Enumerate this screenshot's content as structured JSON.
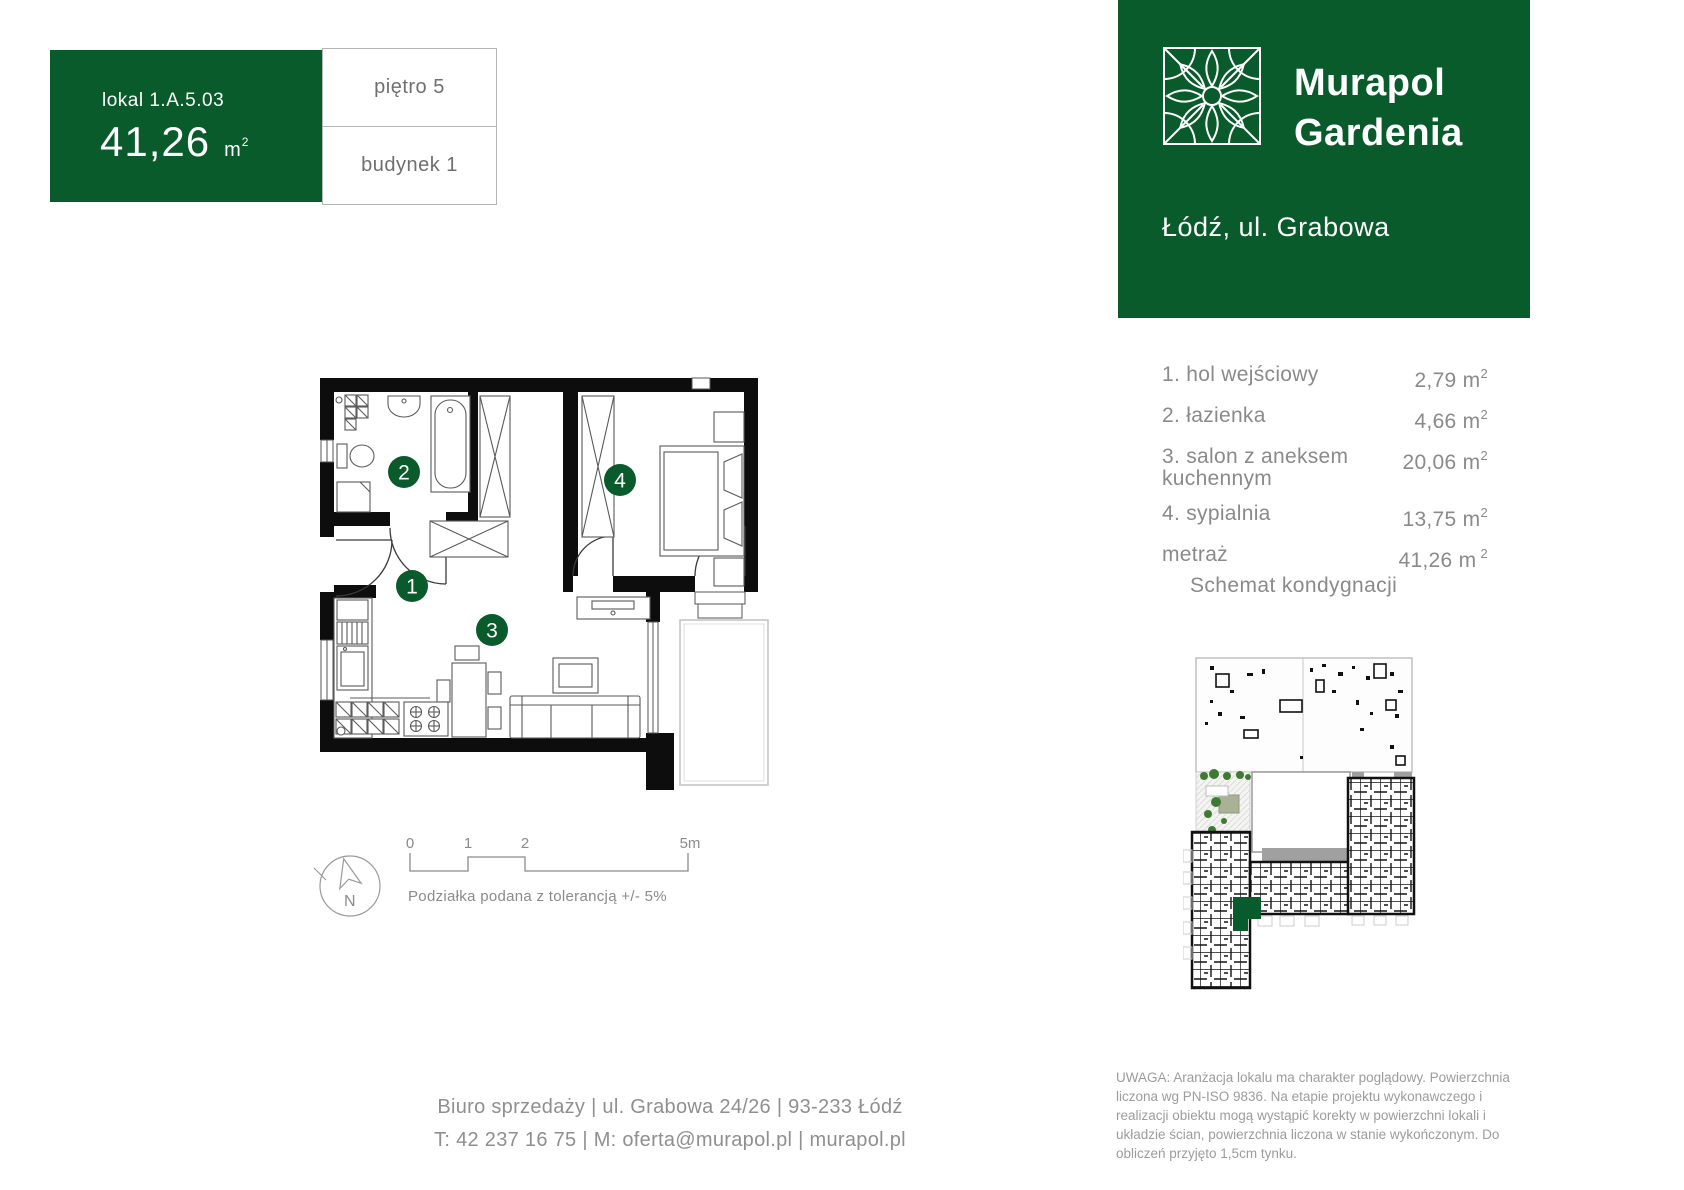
{
  "colors": {
    "brand_green": "#0a5b2c",
    "text_gray": "#8a8a8a"
  },
  "unit_card": {
    "lokal": "lokal 1.A.5.03",
    "area": "41,26",
    "area_unit": "m",
    "area_sup": "2",
    "floor": "piętro 5",
    "building": "budynek 1"
  },
  "brand": {
    "line1": "Murapol",
    "line2": "Gardenia",
    "address": "Łódź, ul. Grabowa",
    "logo_icon": "gardenia-flower-icon"
  },
  "rooms": {
    "items": [
      {
        "label": "1. hol wejściowy",
        "area": "2,79"
      },
      {
        "label": "2. łazienka",
        "area": "4,66"
      },
      {
        "label": "3. salon z aneksem kuchennym",
        "area": "20,06"
      },
      {
        "label": "4. sypialnia",
        "area": "13,75"
      }
    ],
    "unit": "m",
    "sup": "2",
    "total_label": "metraż",
    "total_area": "41,26"
  },
  "floorplan": {
    "numbers": [
      "1",
      "2",
      "3",
      "4"
    ]
  },
  "schematic_title": "Schemat kondygnacji",
  "scalebar": {
    "t0": "0",
    "t1": "1",
    "t2": "2",
    "t5": "5m",
    "note": "Podziałka podana z tolerancją +/- 5%",
    "compass_n": "N"
  },
  "footer": {
    "line1": "Biuro sprzedaży | ul. Grabowa 24/26  | 93-233 Łódź",
    "line2": "T: 42 237 16 75 | M: oferta@murapol.pl | murapol.pl"
  },
  "disclaimer": "UWAGA: Aranżacja lokalu ma charakter poglądowy. Powierzchnia liczona wg PN-ISO 9836. Na etapie projektu wykonawczego i realizacji obiektu mogą wystąpić korekty w powierzchni lokali i układzie ścian, powierzchnia liczona w stanie wykończonym. Do obliczeń przyjęto 1,5cm tynku."
}
